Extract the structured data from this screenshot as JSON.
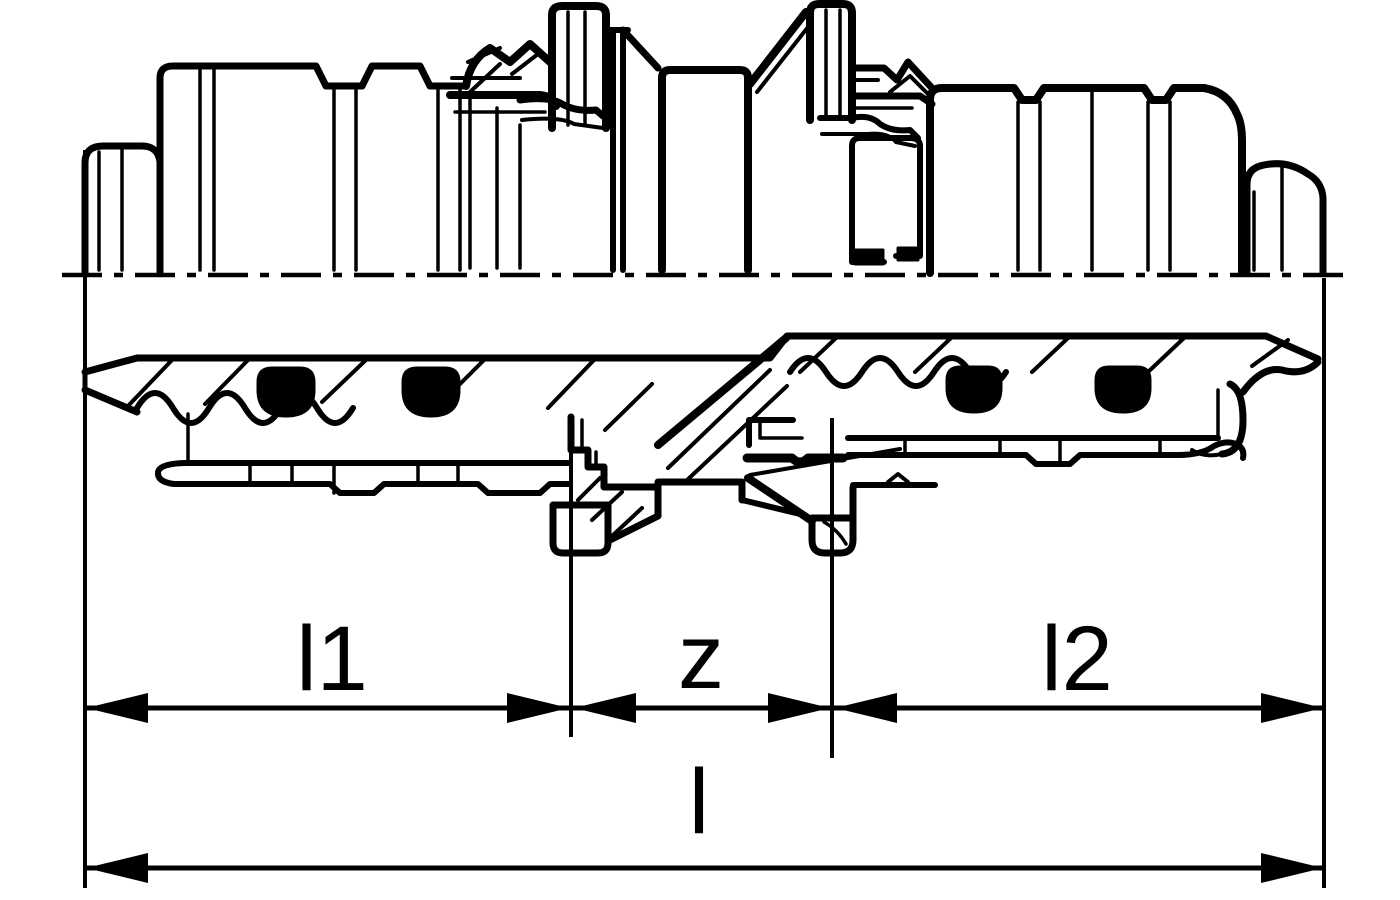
{
  "figure": {
    "background_color": "#ffffff",
    "line_color": "#000000",
    "kind": "pipe press-fitting coupling cross-section"
  },
  "dimension_labels": {
    "l1": "l1",
    "z": "z",
    "l2": "l2",
    "l": "l"
  }
}
